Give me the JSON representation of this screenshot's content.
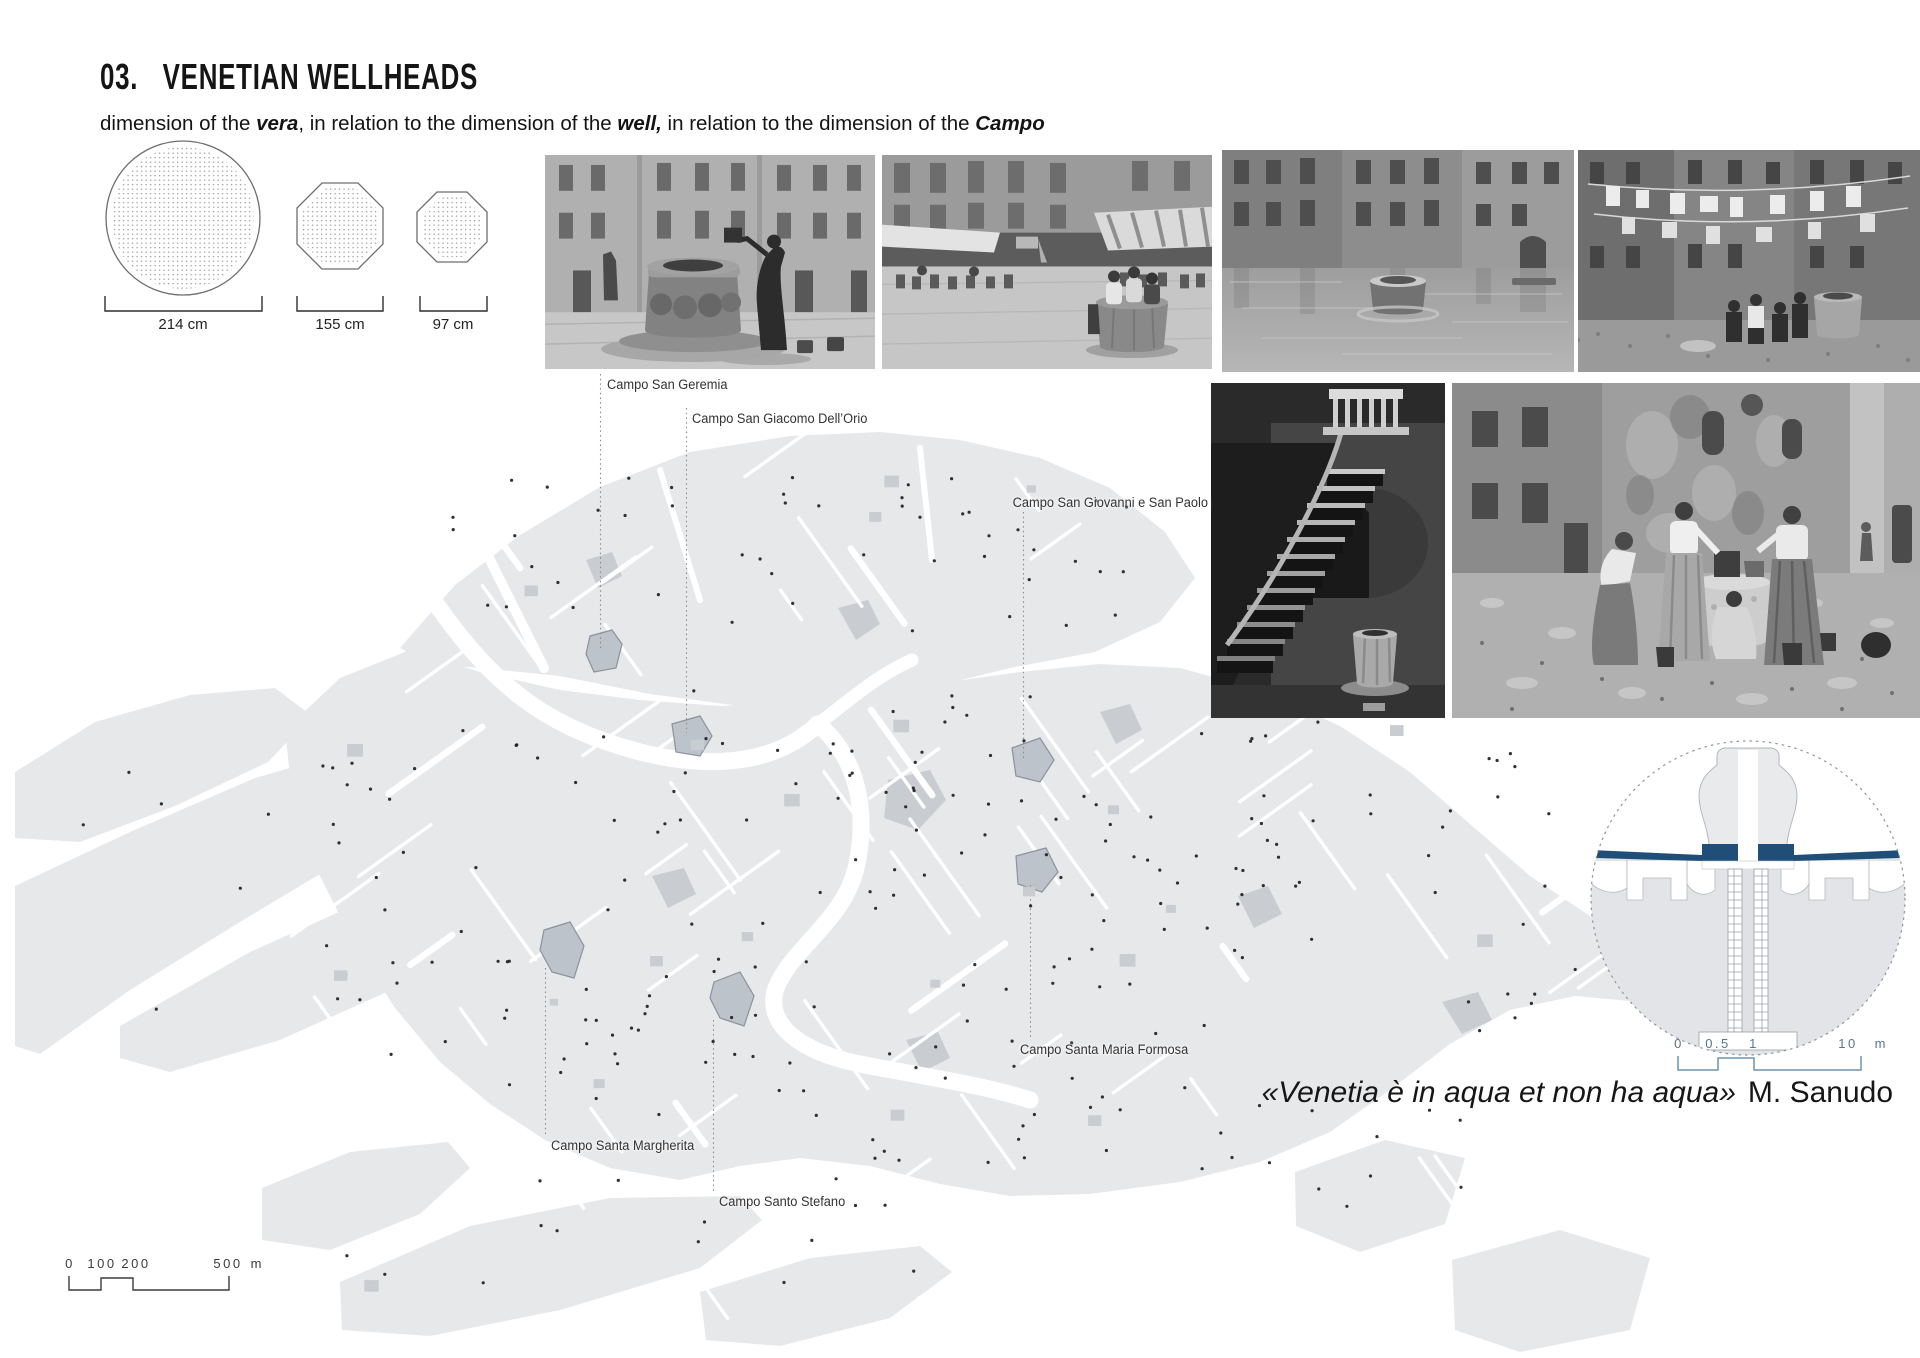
{
  "header": {
    "number": "03.",
    "title": "VENETIAN WELLHEADS",
    "subtitle": {
      "s1": "dimension of the ",
      "b1": "vera",
      "s2": ", in relation to the dimension of the ",
      "b2": "well,",
      "s3": " in relation to the dimension of the ",
      "b3": "Campo"
    }
  },
  "vera_diagrams": {
    "items": [
      {
        "shape": "circular vera",
        "label": "214 cm"
      },
      {
        "shape": "octagonal vera",
        "label": "155 cm"
      },
      {
        "shape": "small octagonal vera",
        "label": "97 cm"
      }
    ]
  },
  "map": {
    "labels": {
      "san_geremia": "Campo San Geremia",
      "san_giacomo": "Campo San Giacomo Dell’Orio",
      "san_giovanni": "Campo San Giovanni e San Paolo",
      "santa_maria_formosa": "Campo Santa Maria Formosa",
      "santa_margherita": "Campo Santa Margherita",
      "santo_stefano": "Campo Santo Stefano"
    },
    "scalebar": {
      "t0": "0",
      "t1": "100",
      "t2": "200",
      "t3": "500",
      "unit": "m"
    }
  },
  "detail": {
    "scalebar": {
      "t0": "0",
      "t1": "0.5",
      "t2": "1",
      "t3": "10",
      "unit": "m"
    }
  },
  "quote": {
    "text": "«Venetia è in aqua et non ha aqua»",
    "author": "M. Sanudo"
  },
  "colors": {
    "map_land": "#e7e8ea",
    "campo_highlight": "#bcc3cb",
    "clay_blue": "#1f4e79",
    "scalebar_blue": "#6b93b4"
  }
}
